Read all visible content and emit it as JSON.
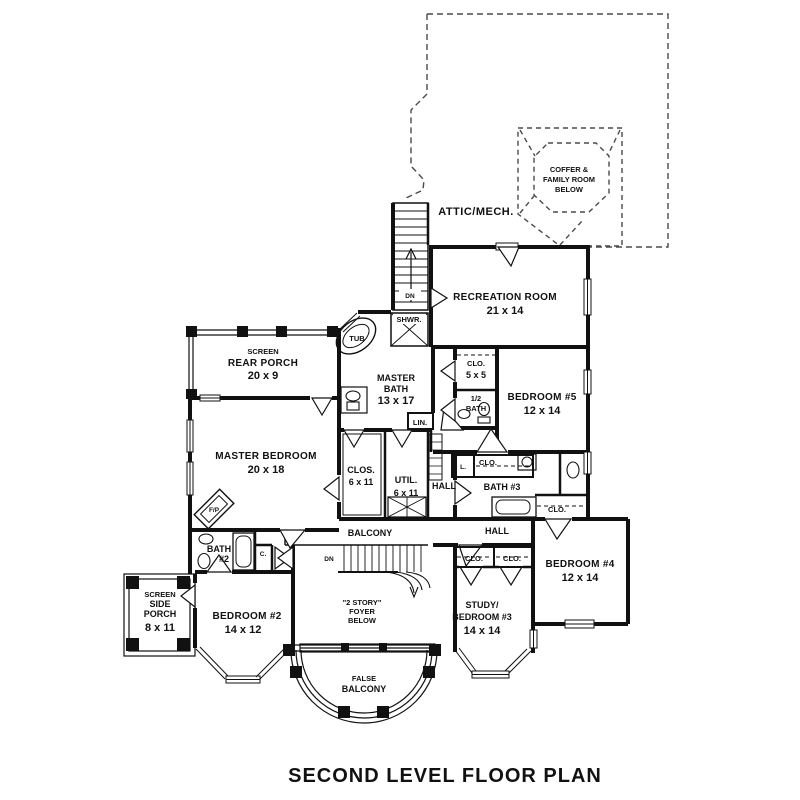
{
  "title": "SECOND LEVEL FLOOR PLAN",
  "colors": {
    "ink": "#111111",
    "dashed_outline": "#4a4a4a",
    "background": "#ffffff"
  },
  "labels": {
    "attic": "ATTIC/MECH.",
    "coffer_line1": "COFFER &",
    "coffer_line2": "FAMILY ROOM",
    "coffer_line3": "BELOW",
    "recreation_name": "RECREATION ROOM",
    "recreation_dims": "21 x 14",
    "rear_porch_type": "SCREEN",
    "rear_porch_name": "REAR PORCH",
    "rear_porch_dims": "20 x 9",
    "master_bath_name1": "MASTER",
    "master_bath_name2": "BATH",
    "master_bath_dims": "13 x 17",
    "master_bedroom_name": "MASTER BEDROOM",
    "master_bedroom_dims": "20 x 18",
    "bedroom5_name": "BEDROOM #5",
    "bedroom5_dims": "12 x 14",
    "bedroom4_name": "BEDROOM #4",
    "bedroom4_dims": "12 x 14",
    "bedroom2_name": "BEDROOM #2",
    "bedroom2_dims": "14 x 12",
    "study_name1": "STUDY/",
    "study_name2": "BEDROOM #3",
    "study_dims": "14 x 14",
    "side_porch_type": "SCREEN",
    "side_porch_name1": "SIDE",
    "side_porch_name2": "PORCH",
    "side_porch_dims": "8 x 11",
    "clo_5x5_name": "CLO.",
    "clo_5x5_dims": "5 x 5",
    "half_bath_line1": "1/2",
    "half_bath_line2": "BATH",
    "clos_name": "CLOS.",
    "clos_dims": "6 x 11",
    "util_name": "UTIL.",
    "util_dims": "6 x 11",
    "bath3": "BATH #3",
    "bath2_line1": "BATH",
    "bath2_line2": "#2",
    "foyer_line1": "\"2 STORY\"",
    "foyer_line2": "FOYER",
    "foyer_line3": "BELOW",
    "balcony": "BALCONY",
    "false_balcony_line1": "FALSE",
    "false_balcony_line2": "BALCONY",
    "hall": "HALL",
    "tub": "TUB",
    "shwr": "SHWR.",
    "lin": "LIN.",
    "clo": "CLO.",
    "dn": "DN",
    "c": "C.",
    "l": "L.",
    "fp": "F/P"
  }
}
